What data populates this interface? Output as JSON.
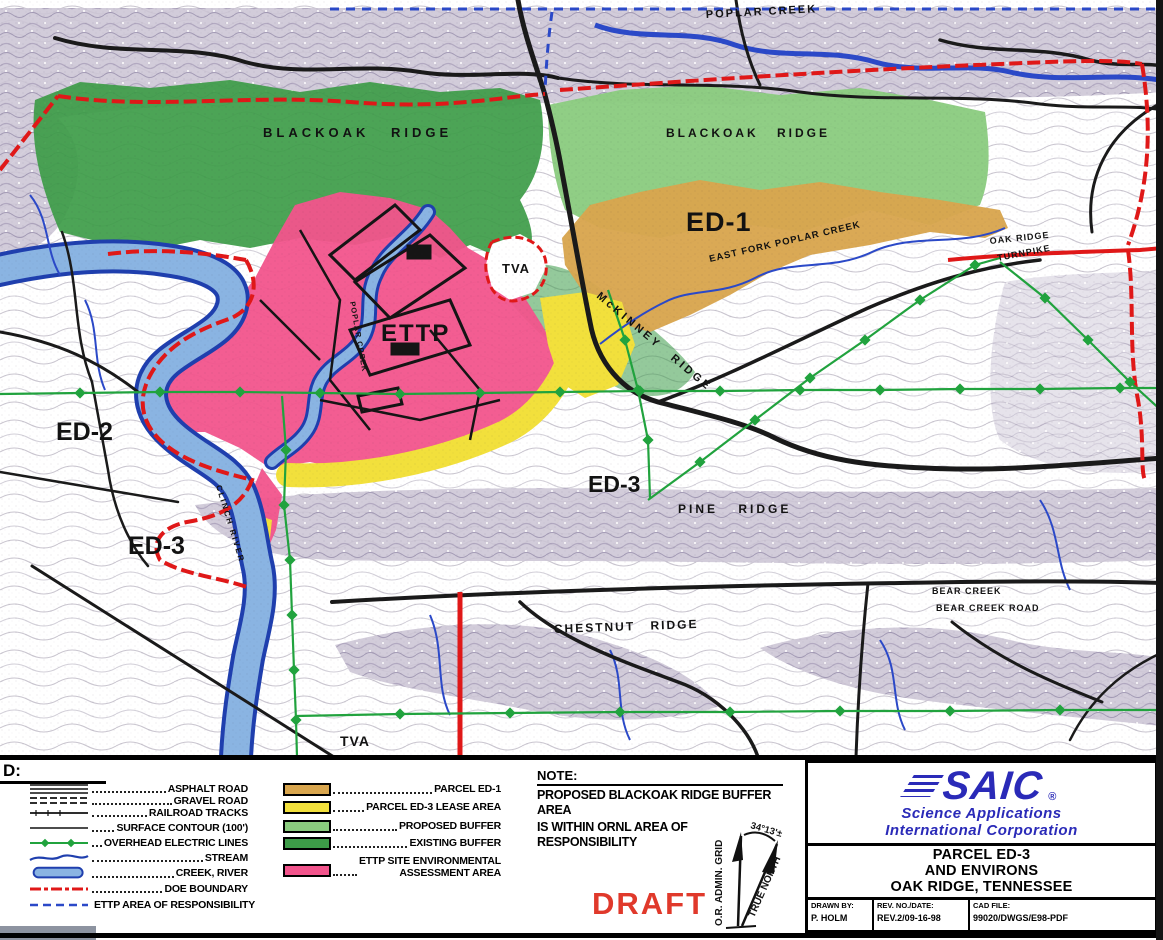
{
  "colors": {
    "parcel_ed1": "#d9a64e",
    "parcel_ed3_lease": "#f2e03c",
    "proposed_buffer": "#8acb7e",
    "existing_buffer": "#3d9c48",
    "ettp_assessment": "#f2548c",
    "river": "#8ab4e2",
    "river_outline": "#1f3fae",
    "doe_red": "#e01818",
    "aor_blue": "#2b49c8",
    "electric_green": "#21a33e",
    "draft_red": "#e0392b",
    "saic_blue": "#2a2ab8"
  },
  "map": {
    "labels": {
      "poplar_creek_top": "POPLAR CREEK",
      "blackoak_ridge_west": "BLACKOAK RIDGE",
      "blackoak_ridge_east": "BLACKOAK RIDGE",
      "ed1": "ED-1",
      "east_fork_poplar_creek": "EAST FORK POPLAR CREEK",
      "oak_ridge_line1": "OAK RIDGE",
      "oak_ridge_line2": "TURNPIKE",
      "mckinney_ridge": "McKINNEY RIDGE",
      "tva_upper": "TVA",
      "ettp": "ETTP",
      "poplar_creek_inner": "POPLAR CREEK",
      "ed2": "ED-2",
      "ed3_west": "ED-3",
      "ed3_center": "ED-3",
      "clinch_river": "CLINCH RIVER",
      "pine_ridge": "PINE RIDGE",
      "chestnut_ridge": "CHESTNUT RIDGE",
      "bear_creek": "BEAR CREEK",
      "bear_creek_road": "BEAR CREEK ROAD",
      "tva_lower": "TVA"
    }
  },
  "legend": {
    "title": "D:",
    "line_items": [
      {
        "id": "asphalt-road",
        "label": "ASPHALT ROAD"
      },
      {
        "id": "gravel-road",
        "label": "GRAVEL ROAD"
      },
      {
        "id": "railroad-tracks",
        "label": "RAILROAD TRACKS"
      },
      {
        "id": "surface-contour",
        "label": "SURFACE CONTOUR (100')"
      },
      {
        "id": "overhead-electric-lines",
        "label": "OVERHEAD ELECTRIC LINES"
      },
      {
        "id": "stream",
        "label": "STREAM"
      },
      {
        "id": "creek-river",
        "label": "CREEK, RIVER"
      },
      {
        "id": "doe-boundary",
        "label": "DOE BOUNDARY"
      },
      {
        "id": "ettp-area-of-responsibility",
        "label": "ETTP AREA OF RESPONSIBILITY"
      }
    ],
    "area_items": [
      {
        "id": "parcel-ed1",
        "label": "PARCEL ED-1",
        "color": "#d9a64e"
      },
      {
        "id": "parcel-ed3-lease-area",
        "label": "PARCEL ED-3 LEASE AREA",
        "color": "#f2e03c"
      },
      {
        "id": "proposed-buffer",
        "label": "PROPOSED BUFFER",
        "color": "#8acb7e"
      },
      {
        "id": "existing-buffer",
        "label": "EXISTING BUFFER",
        "color": "#3d9c48"
      },
      {
        "id": "ettp-site-environmental-assessment-area",
        "label_line1": "ETTP SITE ENVIRONMENTAL",
        "label_line2": "ASSESSMENT AREA",
        "color": "#f2548c"
      }
    ]
  },
  "note": {
    "title": "NOTE:",
    "line1": "PROPOSED BLACKOAK RIDGE BUFFER AREA",
    "line2": "IS WITHIN ORNL AREA OF RESPONSIBILITY"
  },
  "compass": {
    "grid_label": "O.R. ADMIN. GRID",
    "north_label": "TRUE NORTH",
    "angle": "34°13'±"
  },
  "draft": "DRAFT",
  "title_block": {
    "logo": "SAIC",
    "logo_reg": "®",
    "company_line1": "Science Applications",
    "company_line2": "International Corporation",
    "title_line1": "PARCEL ED-3",
    "title_line2": "AND ENVIRONS",
    "title_line3": "OAK RIDGE, TENNESSEE",
    "drawn_by_label": "DRAWN BY:",
    "drawn_by_value": "P. HOLM",
    "rev_label": "REV. NO./DATE:",
    "rev_value": "REV.2/09-16-98",
    "cad_label": "CAD FILE:",
    "cad_value": "99020/DWGS/E98-PDF"
  }
}
